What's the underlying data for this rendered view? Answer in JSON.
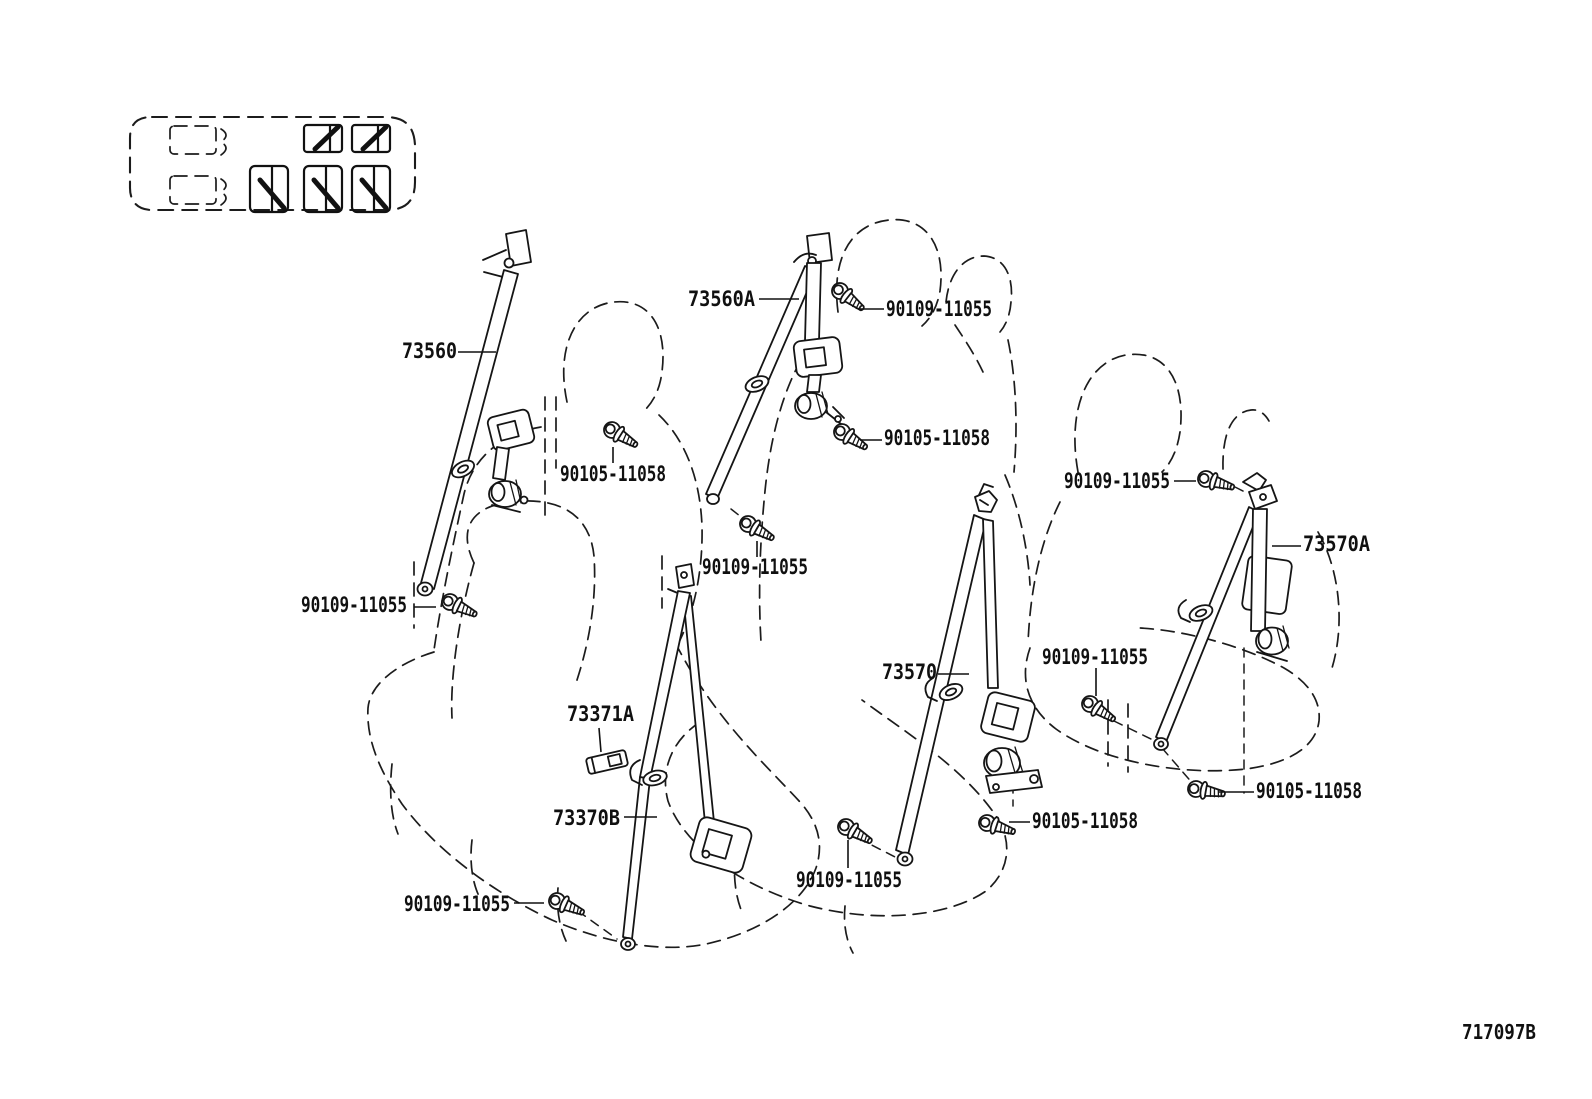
{
  "drawing_number": "717097B",
  "part_numbers": [
    "73560",
    "73560A",
    "73570",
    "73570A",
    "73371A",
    "73370B",
    "90109-11055",
    "90105-11058"
  ],
  "callouts": [
    "73560",
    "73560A",
    "90109-11055",
    "90105-11058",
    "90105-11058",
    "90109-11055",
    "90109-11055",
    "90109-11055",
    "73570A",
    "90109-11055",
    "73570",
    "73371A",
    "73370B",
    "90105-11058",
    "90105-11058",
    "90109-11055",
    "90109-11055"
  ],
  "vehicle_schematic": {
    "front_seat_positions": 2,
    "seatbelt_positions": 5
  },
  "colors": {
    "line": "#151515",
    "background": "#ffffff"
  }
}
